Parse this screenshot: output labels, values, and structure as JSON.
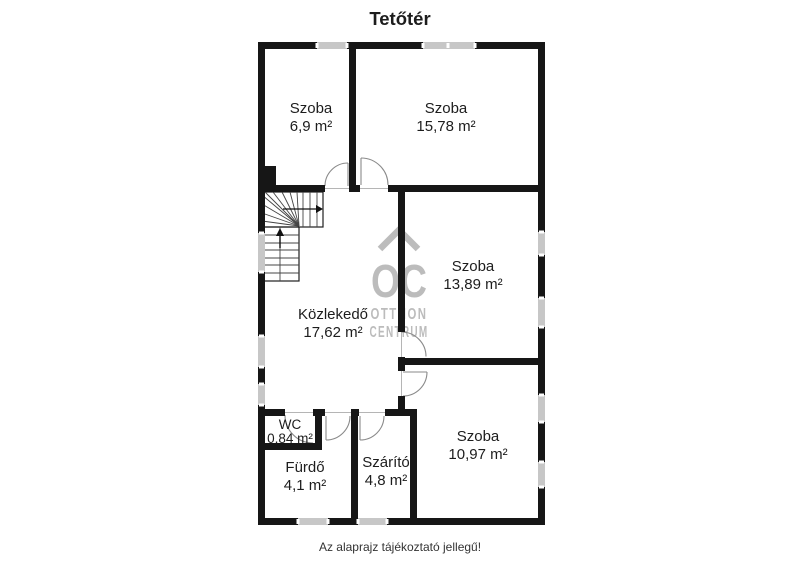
{
  "title": "Tetőtér",
  "note": "Az alaprajz tájékoztató jellegű!",
  "watermark": {
    "monogram": "OC",
    "line1": "OTTHON",
    "line2": "CENTRUM"
  },
  "rooms": [
    {
      "name": "Szoba",
      "area": "6,9 m²"
    },
    {
      "name": "Szoba",
      "area": "15,78 m²"
    },
    {
      "name": "Szoba",
      "area": "13,89 m²"
    },
    {
      "name": "Közlekedő",
      "area": "17,62 m²"
    },
    {
      "name": "WC",
      "area": "0,84 m²"
    },
    {
      "name": "Fürdő",
      "area": "4,1 m²"
    },
    {
      "name": "Szárító",
      "area": "4,8 m²"
    },
    {
      "name": "Szoba",
      "area": "10,97 m²"
    }
  ],
  "colors": {
    "wall": "#161616",
    "window": "#c7c7c7",
    "watermark": "#bcbcbc",
    "text": "#1d1d1d",
    "note": "#333333"
  }
}
